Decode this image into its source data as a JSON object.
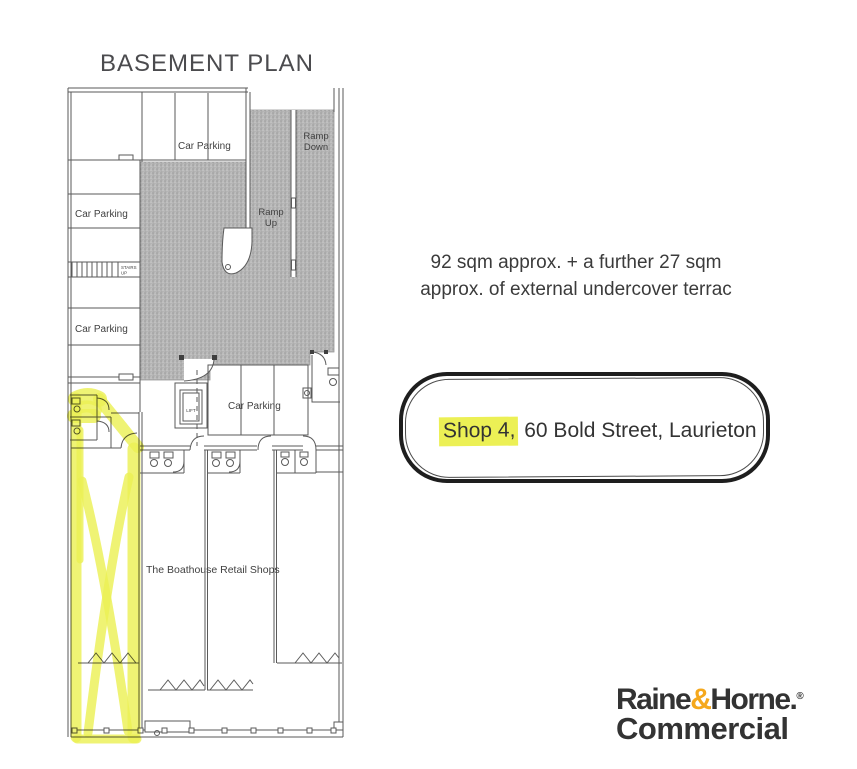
{
  "page": {
    "title": "BASEMENT PLAN"
  },
  "plan": {
    "labels": {
      "car_parking_top": "Car Parking",
      "car_parking_left_upper": "Car Parking",
      "car_parking_left_lower": "Car Parking",
      "car_parking_center": "Car Parking",
      "ramp_down_1": "Ramp",
      "ramp_down_2": "Down",
      "ramp_up_1": "Ramp",
      "ramp_up_2": "Up",
      "stairs_1": "STAIRS",
      "stairs_2": "UP",
      "lift": "LIFT",
      "retail": "The Boathouse Retail Shops"
    }
  },
  "notes": {
    "area_line1": "92 sqm approx. + a further 27 sqm",
    "area_line2": "approx. of external undercover terrac"
  },
  "address": {
    "highlighted": "Shop 4,",
    "rest": " 60 Bold Street, Laurieton"
  },
  "logo": {
    "word1": "Raine",
    "ampersand": "&",
    "word2": "Horne.",
    "registered": "®",
    "word3": "Commercial"
  },
  "colors": {
    "highlighter": "#ecf055",
    "plan_gray": "#b5b5b5",
    "logo_amp": "#f5a81c",
    "logo_text": "#333333",
    "outline": "#1e1e1e",
    "line": "#5a5a5a"
  }
}
